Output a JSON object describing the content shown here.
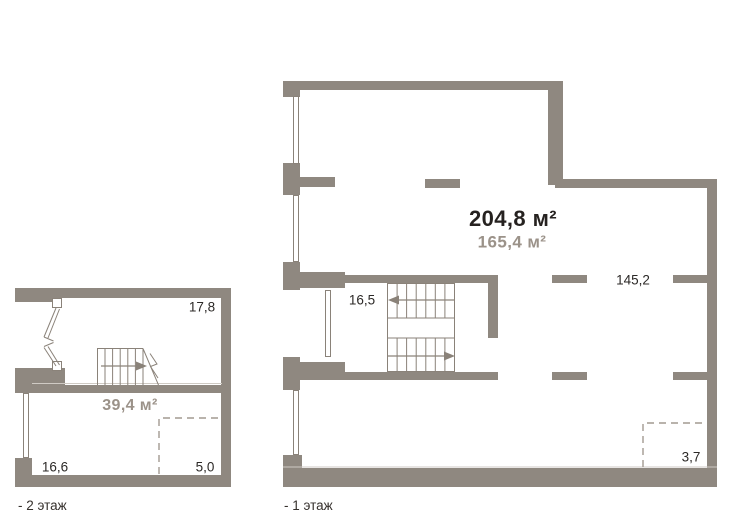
{
  "page": {
    "background": "#ffffff"
  },
  "colors": {
    "wall": "#8f8880",
    "thin_line": "#8a8279",
    "light_edge": "#cfcac4",
    "dash": "#a29a91",
    "text_dark": "#2c2927",
    "text_gray": "#9b9289"
  },
  "floor1": {
    "label": "- 1 этаж",
    "total_area": "204,8 м²",
    "secondary_area": "165,4 м²",
    "rooms": [
      {
        "id": "16-5",
        "value": "16,5"
      },
      {
        "id": "145-2",
        "value": "145,2"
      },
      {
        "id": "3-7",
        "value": "3,7"
      }
    ],
    "stairs": {
      "upper_run_arrow": "left",
      "lower_run_arrow": "right"
    }
  },
  "floor2": {
    "label": "- 2 этаж",
    "area": "39,4 м²",
    "rooms": [
      {
        "id": "17-8",
        "value": "17,8"
      },
      {
        "id": "16-6",
        "value": "16,6"
      },
      {
        "id": "5-0",
        "value": "5,0"
      }
    ],
    "stairs": {
      "run_arrow": "right"
    }
  }
}
